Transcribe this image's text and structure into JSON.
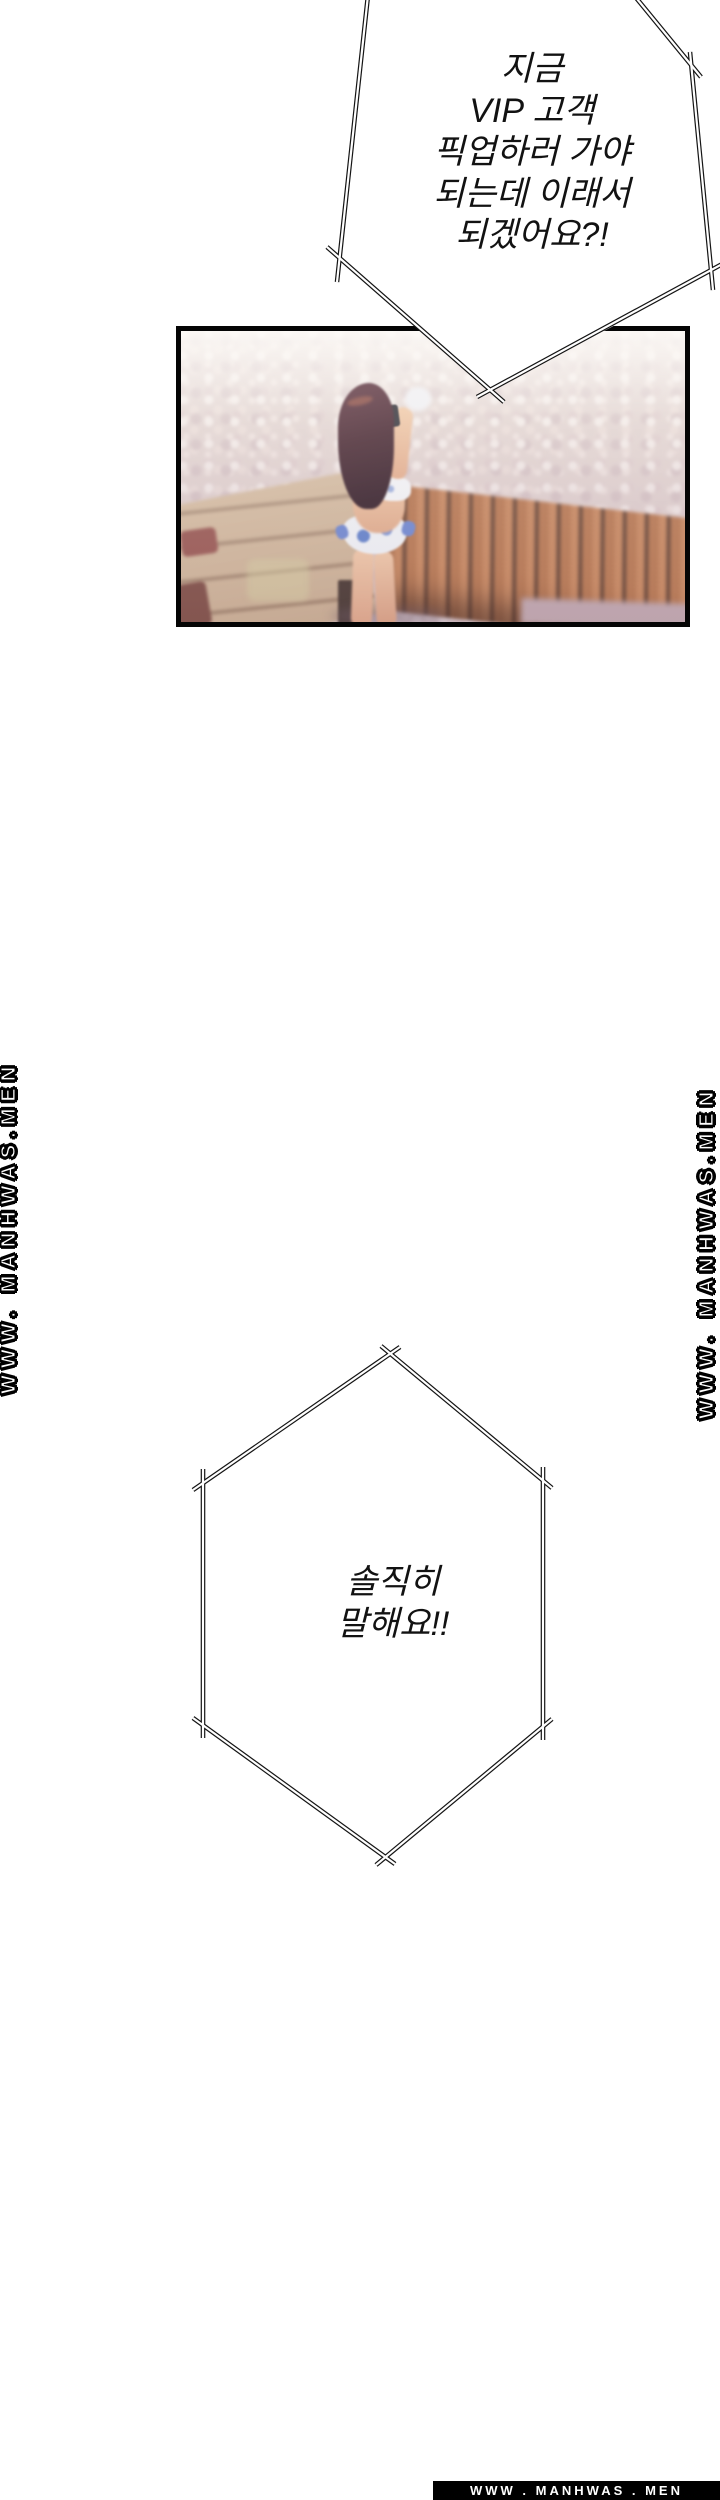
{
  "bubble_top": {
    "lines": [
      "지금",
      "VIP 고객",
      "픽업하러 가야",
      "되는데 이래서",
      "되겠어요?!"
    ]
  },
  "bubble_hex": {
    "lines": [
      "솔직히",
      "말해요!!"
    ]
  },
  "watermarks": {
    "left": "WWW. MANHWAS.MEN",
    "right": "WWW. MANHWAS.MEN"
  },
  "footer": {
    "text": "WWW . MANHWAS . MEN",
    "bg": "#000000",
    "text_color": "#ffffff"
  },
  "panel": {
    "alt": "blurred illustration of a long-haired woman in a white and blue bikini taking a photo, standing on a pool deck with pebbled ground, wooden bench and deck planks",
    "colors": {
      "border": "#050505",
      "pebble_light": "#f4ece7",
      "pebble_shadow": "#cdb9bc",
      "bench_wood": "#b5744c",
      "bench_gap": "#63402f",
      "deck_wood": "#c9ae90",
      "deck_line": "#7e5f49",
      "stone_red": "#96544e",
      "hair": "#46262f",
      "skin": "#eec6a6",
      "bikini_white": "#eef1f5",
      "bikini_blue": "#5d7ec9",
      "ink": "#121212"
    }
  }
}
